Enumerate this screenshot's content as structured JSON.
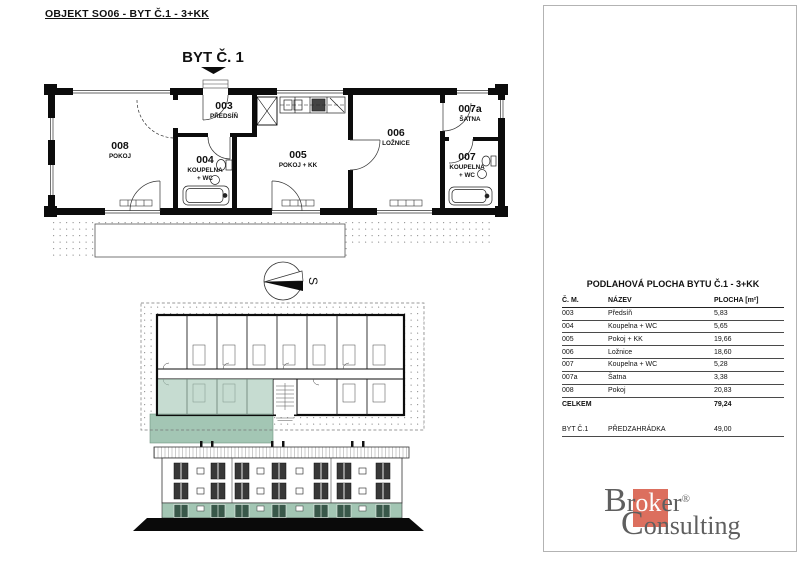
{
  "header": {
    "title": "OBJEKT SO06 - BYT Č.1 - 3+KK"
  },
  "floor_plan": {
    "label": "BYT Č. 1",
    "compass_label": "S",
    "rooms": [
      {
        "number": "008",
        "lines": [
          "POKOJ",
          ""
        ]
      },
      {
        "number": "003",
        "lines": [
          "PŘEDSÍŇ",
          ""
        ]
      },
      {
        "number": "004",
        "lines": [
          "KOUPELNA",
          "+ WC"
        ]
      },
      {
        "number": "005",
        "lines": [
          "POKOJ + KK",
          ""
        ]
      },
      {
        "number": "006",
        "lines": [
          "LOŽNICE",
          ""
        ]
      },
      {
        "number": "007a",
        "lines": [
          "ŠATNA",
          ""
        ]
      },
      {
        "number": "007",
        "lines": [
          "KOUPELNA",
          "+ WC"
        ]
      }
    ]
  },
  "site_plan": {
    "compass_label": "S",
    "highlighted": "SO 06",
    "buildings": [
      "SO 03",
      "SO 11",
      "SO 02",
      "SO 01",
      "SO 10",
      "SO 04",
      "SO 05",
      "SO 06",
      "SO 08",
      "SO 09",
      "SO 12",
      "SO 07"
    ]
  },
  "area_table": {
    "title": "PODLAHOVÁ PLOCHA BYTU Č.1 - 3+KK",
    "columns": [
      "Č. M.",
      "NÁZEV",
      "PLOCHA [m²]"
    ],
    "rows": [
      [
        "003",
        "Předsíň",
        "5,83"
      ],
      [
        "004",
        "Koupelna + WC",
        "5,65"
      ],
      [
        "005",
        "Pokoj + KK",
        "19,66"
      ],
      [
        "006",
        "Ložnice",
        "18,60"
      ],
      [
        "007",
        "Koupelna + WC",
        "5,28"
      ],
      [
        "007a",
        "Šatna",
        "3,38"
      ],
      [
        "008",
        "Pokoj",
        "20,83"
      ]
    ],
    "total_label": "CELKEM",
    "total_value": "79,24",
    "extra_row": [
      "BYT Č.1",
      "PŘEDZAHRÁDKA",
      "49,00"
    ]
  },
  "logo": {
    "b": "B",
    "r1": "r",
    "ok": "ok",
    "er": "er",
    "reg": "®",
    "c": "C",
    "onsulting": "onsulting"
  },
  "colors": {
    "accent_green": "#a3c6b4",
    "site_bg": "#d3e2d9",
    "highlight_green": "#56896d",
    "logo_red": "#dc6f5e"
  }
}
